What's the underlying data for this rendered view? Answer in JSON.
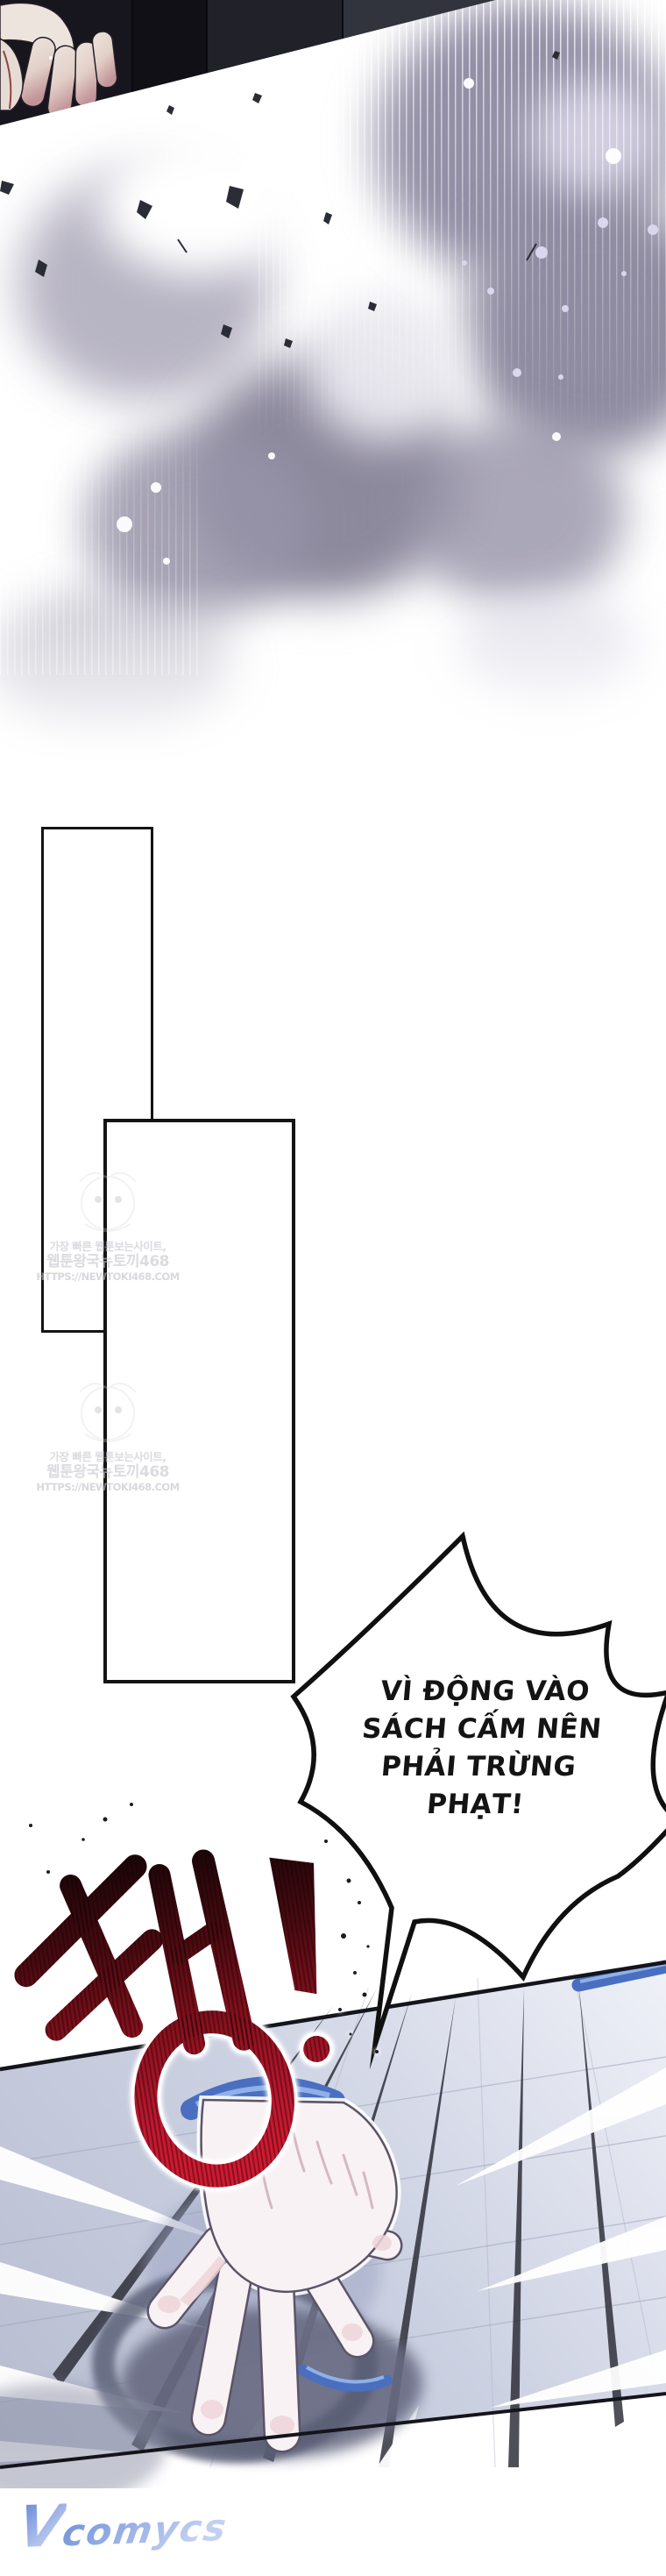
{
  "speech_bubble": {
    "lines": [
      "VÌ ĐỘNG VÀO",
      "SÁCH CẤM NÊN",
      "PHẢI TRỪNG",
      "PHẠT!"
    ]
  },
  "sfx": {
    "text": "쾅!"
  },
  "watermark": {
    "tagline": "가장 빠른 웹툰보는사이트,",
    "site_name": "웹툰왕국뉴토끼468",
    "url": "HTTPS://NEWTOKI468.COM"
  },
  "publisher_logo": {
    "text": "VCOMYCS",
    "initial": "V",
    "rest": "comycs"
  },
  "colors": {
    "sfx_red": "#b5152a",
    "magic_blue": "#4a6fc0",
    "smoke_purple": "#938fa6",
    "panel_dark": "#17161e",
    "floor_light": "#eef0f7",
    "logo_blue": "#6e8fd8"
  }
}
